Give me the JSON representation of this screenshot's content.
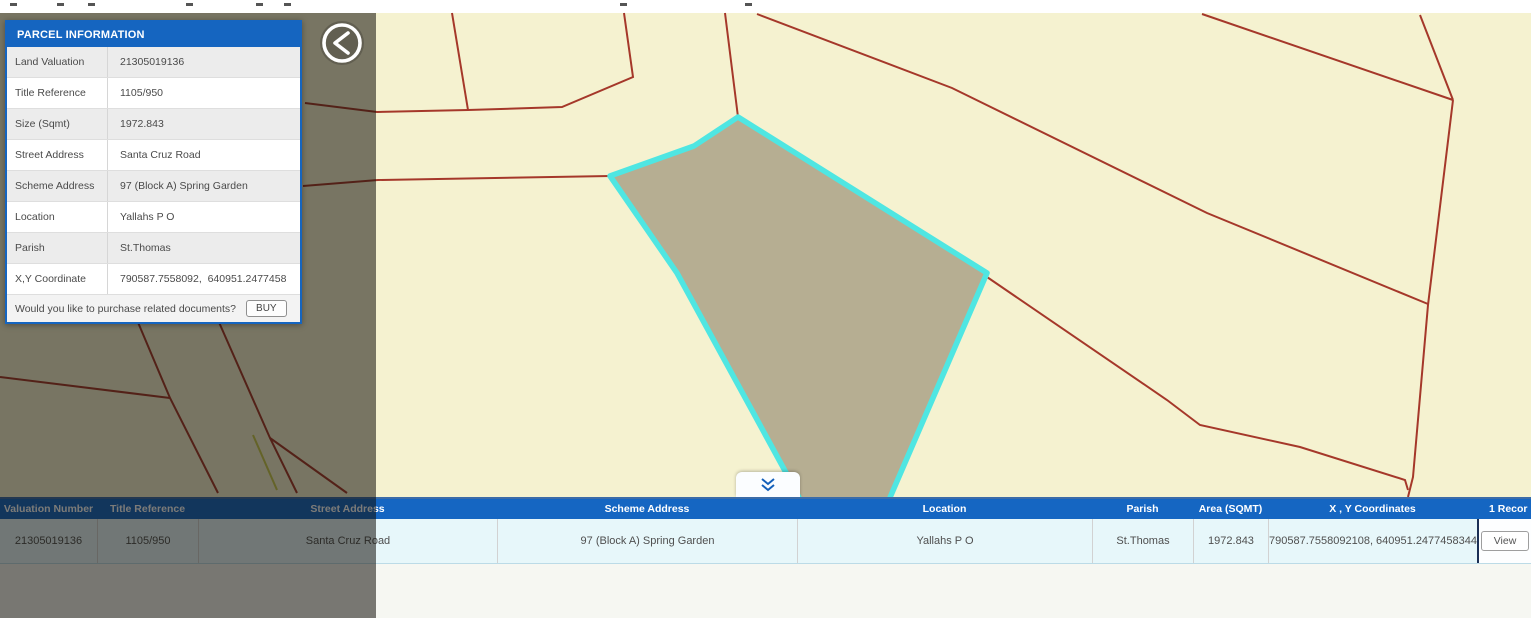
{
  "panel": {
    "title": "PARCEL INFORMATION",
    "rows": [
      {
        "label": "Land Valuation",
        "value": "21305019136"
      },
      {
        "label": "Title Reference",
        "value": "1105/950"
      },
      {
        "label": "Size (Sqmt)",
        "value": "1972.843"
      },
      {
        "label": "Street Address",
        "value": "Santa Cruz Road"
      },
      {
        "label": "Scheme Address",
        "value": "97 (Block A) Spring Garden"
      },
      {
        "label": "Location",
        "value": "Yallahs P O"
      },
      {
        "label": "Parish",
        "value": "St.Thomas"
      },
      {
        "label": "X,Y Coordinate",
        "value": "790587.7558092,  640951.2477458"
      }
    ],
    "footer_text": "Would you like to purchase related documents?",
    "buy_label": "BUY"
  },
  "back_button": {
    "icon": "chevron-left-circle"
  },
  "collapse_button": {
    "icon": "double-chevron-down"
  },
  "table": {
    "headers": [
      "Valuation Number",
      "Title Reference",
      "Street Address",
      "Scheme Address",
      "Location",
      "Parish",
      "Area (SQMT)",
      "X , Y Coordinates",
      "1 Recor"
    ],
    "row": [
      "21305019136",
      "1105/950",
      "Santa Cruz Road",
      "97 (Block A) Spring Garden",
      "Yallahs P O",
      "St.Thomas",
      "1972.843",
      "790587.7558092108, 640951.2477458344"
    ],
    "view_label": "View"
  },
  "map": {
    "colors": {
      "land": "#f5f2d0",
      "boundary_red": "#a5382a",
      "boundary_yellow": "#c9c94e",
      "parcel_fill": "#b6ae92",
      "parcel_highlight": "#4fe6e2",
      "top_strip": "#ffffff",
      "accent_blue": "#1565c0"
    },
    "selected_parcel_points": [
      [
        738,
        117
      ],
      [
        694,
        146
      ],
      [
        610,
        176
      ],
      [
        677,
        273
      ],
      [
        790,
        480
      ],
      [
        831,
        560
      ],
      [
        863,
        560
      ],
      [
        987,
        273
      ]
    ],
    "red_lines": [
      [
        [
          452,
          13
        ],
        [
          468,
          110
        ]
      ],
      [
        [
          305,
          103
        ],
        [
          377,
          112
        ],
        [
          468,
          110
        ],
        [
          562,
          107
        ],
        [
          633,
          77
        ],
        [
          624,
          13
        ]
      ],
      [
        [
          725,
          13
        ],
        [
          738,
          117
        ]
      ],
      [
        [
          303,
          186
        ],
        [
          378,
          180
        ],
        [
          610,
          176
        ]
      ],
      [
        [
          757,
          14
        ],
        [
          952,
          88
        ],
        [
          1207,
          213
        ],
        [
          1428,
          304
        ]
      ],
      [
        [
          1202,
          14
        ],
        [
          1453,
          100
        ]
      ],
      [
        [
          1420,
          15
        ],
        [
          1453,
          100
        ]
      ],
      [
        [
          1453,
          100
        ],
        [
          1428,
          305
        ],
        [
          1413,
          477
        ],
        [
          1408,
          497
        ]
      ],
      [
        [
          987,
          277
        ],
        [
          1167,
          400
        ],
        [
          1200,
          425
        ],
        [
          1300,
          447
        ],
        [
          1405,
          480
        ],
        [
          1408,
          490
        ]
      ],
      [
        [
          0,
          377
        ],
        [
          170,
          398
        ]
      ],
      [
        [
          137,
          320
        ],
        [
          170,
          398
        ],
        [
          218,
          493
        ]
      ],
      [
        [
          218,
          320
        ],
        [
          270,
          438
        ],
        [
          297,
          493
        ]
      ],
      [
        [
          270,
          438
        ],
        [
          347,
          493
        ]
      ]
    ],
    "yellow_lines": [
      [
        [
          253,
          435
        ],
        [
          277,
          490
        ]
      ]
    ],
    "top_strip_dashes": [
      10,
      57,
      88,
      186,
      256,
      284,
      620,
      745
    ]
  }
}
